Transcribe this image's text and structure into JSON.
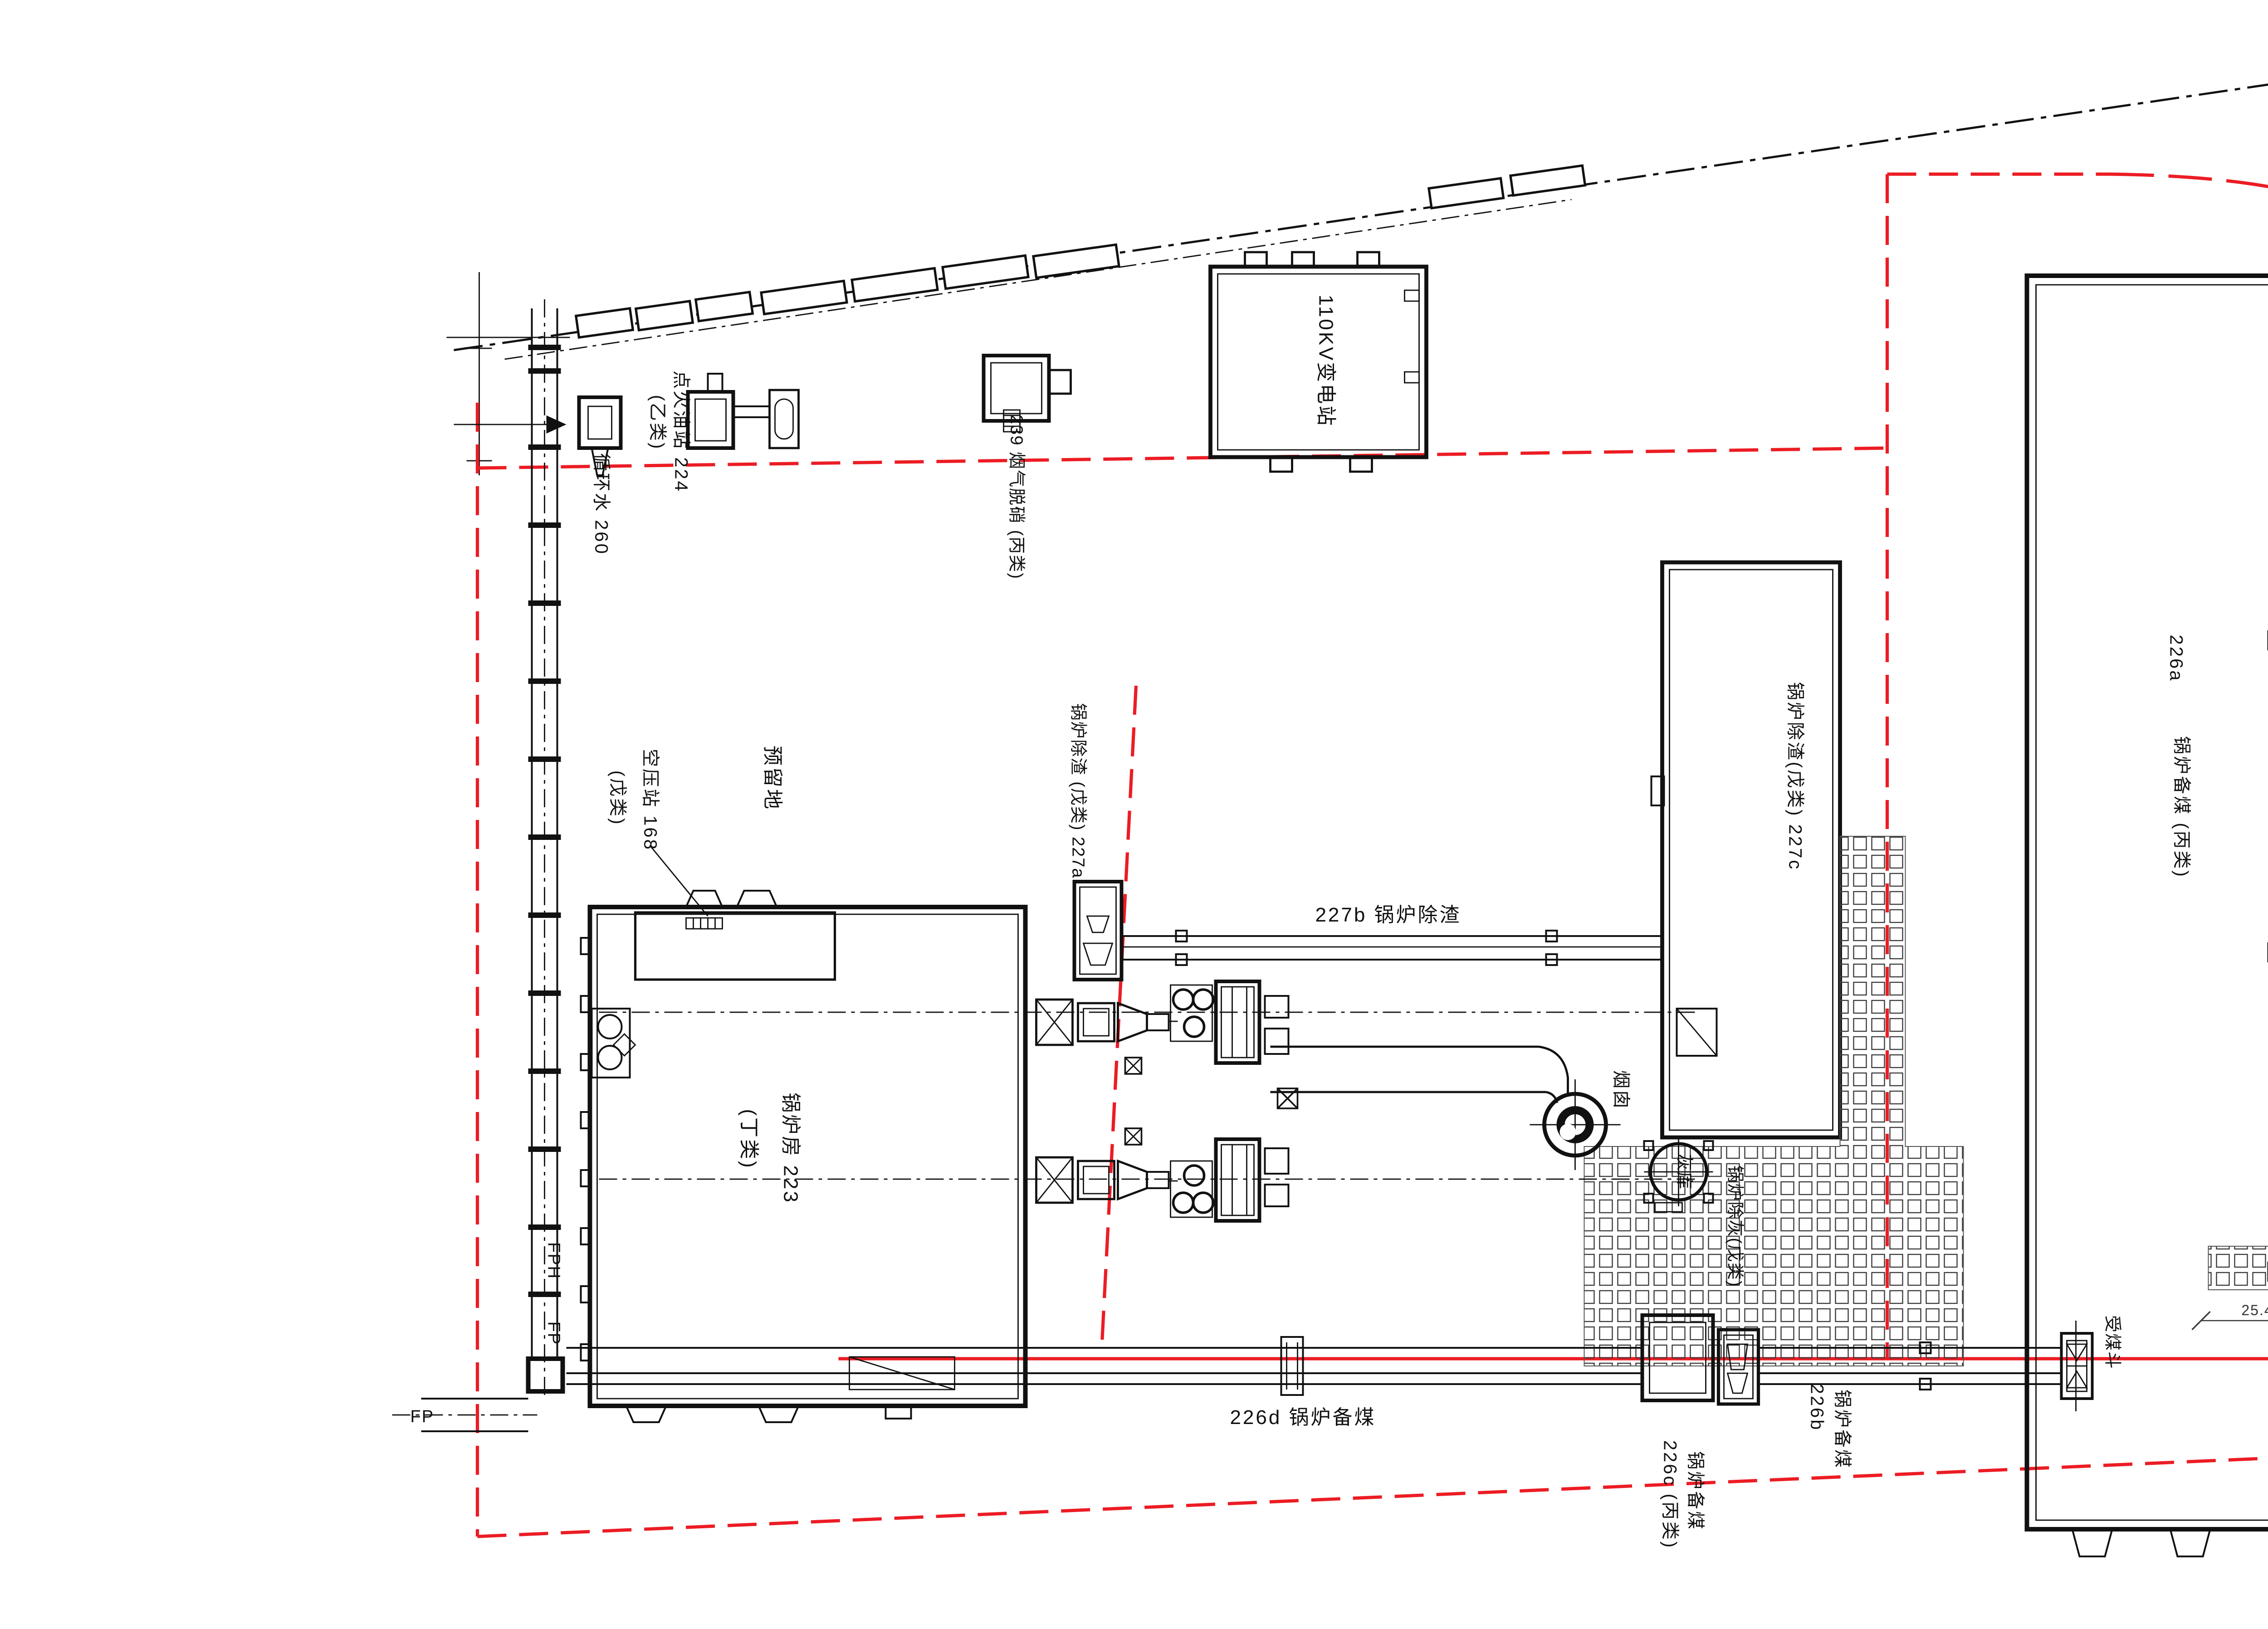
{
  "labels": {
    "substation_110kv": "110KV变电站",
    "ignition_oil_station": "点火油站 224",
    "ignition_oil_class": "(乙类)",
    "circulating_water": "循环水 260",
    "denitration_239": "239 烟气脱硝 (丙类)",
    "slag_227a": "锅炉除渣 (戊类) 227a",
    "slag_227b": "227b 锅炉除渣",
    "slag_227c": "锅炉除渣(戊类) 227c",
    "coal_226a_no": "226a",
    "coal_226a_name": "锅炉备煤 (丙类)",
    "reserved_land": "预留地",
    "air_compressor": "空压站 168",
    "air_compressor_class": "(戊类)",
    "boiler_house_name": "锅炉房  223",
    "boiler_house_class": "(丁类)",
    "chimney": "烟囱",
    "ash_silo": "灰库",
    "ash_removal": "锅炉除灰(戊类)",
    "coal_hopper": "受煤斗",
    "coal_226d": "226d 锅炉备煤",
    "coal_226b_name": "锅炉备煤",
    "coal_226b_no": "226b",
    "coal_226c_name": "锅炉备煤",
    "coal_226c_no": "226c (丙类)",
    "road_fph": "FPH",
    "road_fp": "FP",
    "fp_bottom": "FP",
    "dim_24_7": "24.7",
    "dim_25_4": "25.4",
    "logo_cncec": "CNCEC",
    "company_name": "赛鼎公司"
  },
  "colors": {
    "boundary_red": "#ec1c24",
    "line_black": "#111111",
    "logo_blue": "#1d3e8f",
    "logo_yellow": "#f2c31d"
  }
}
